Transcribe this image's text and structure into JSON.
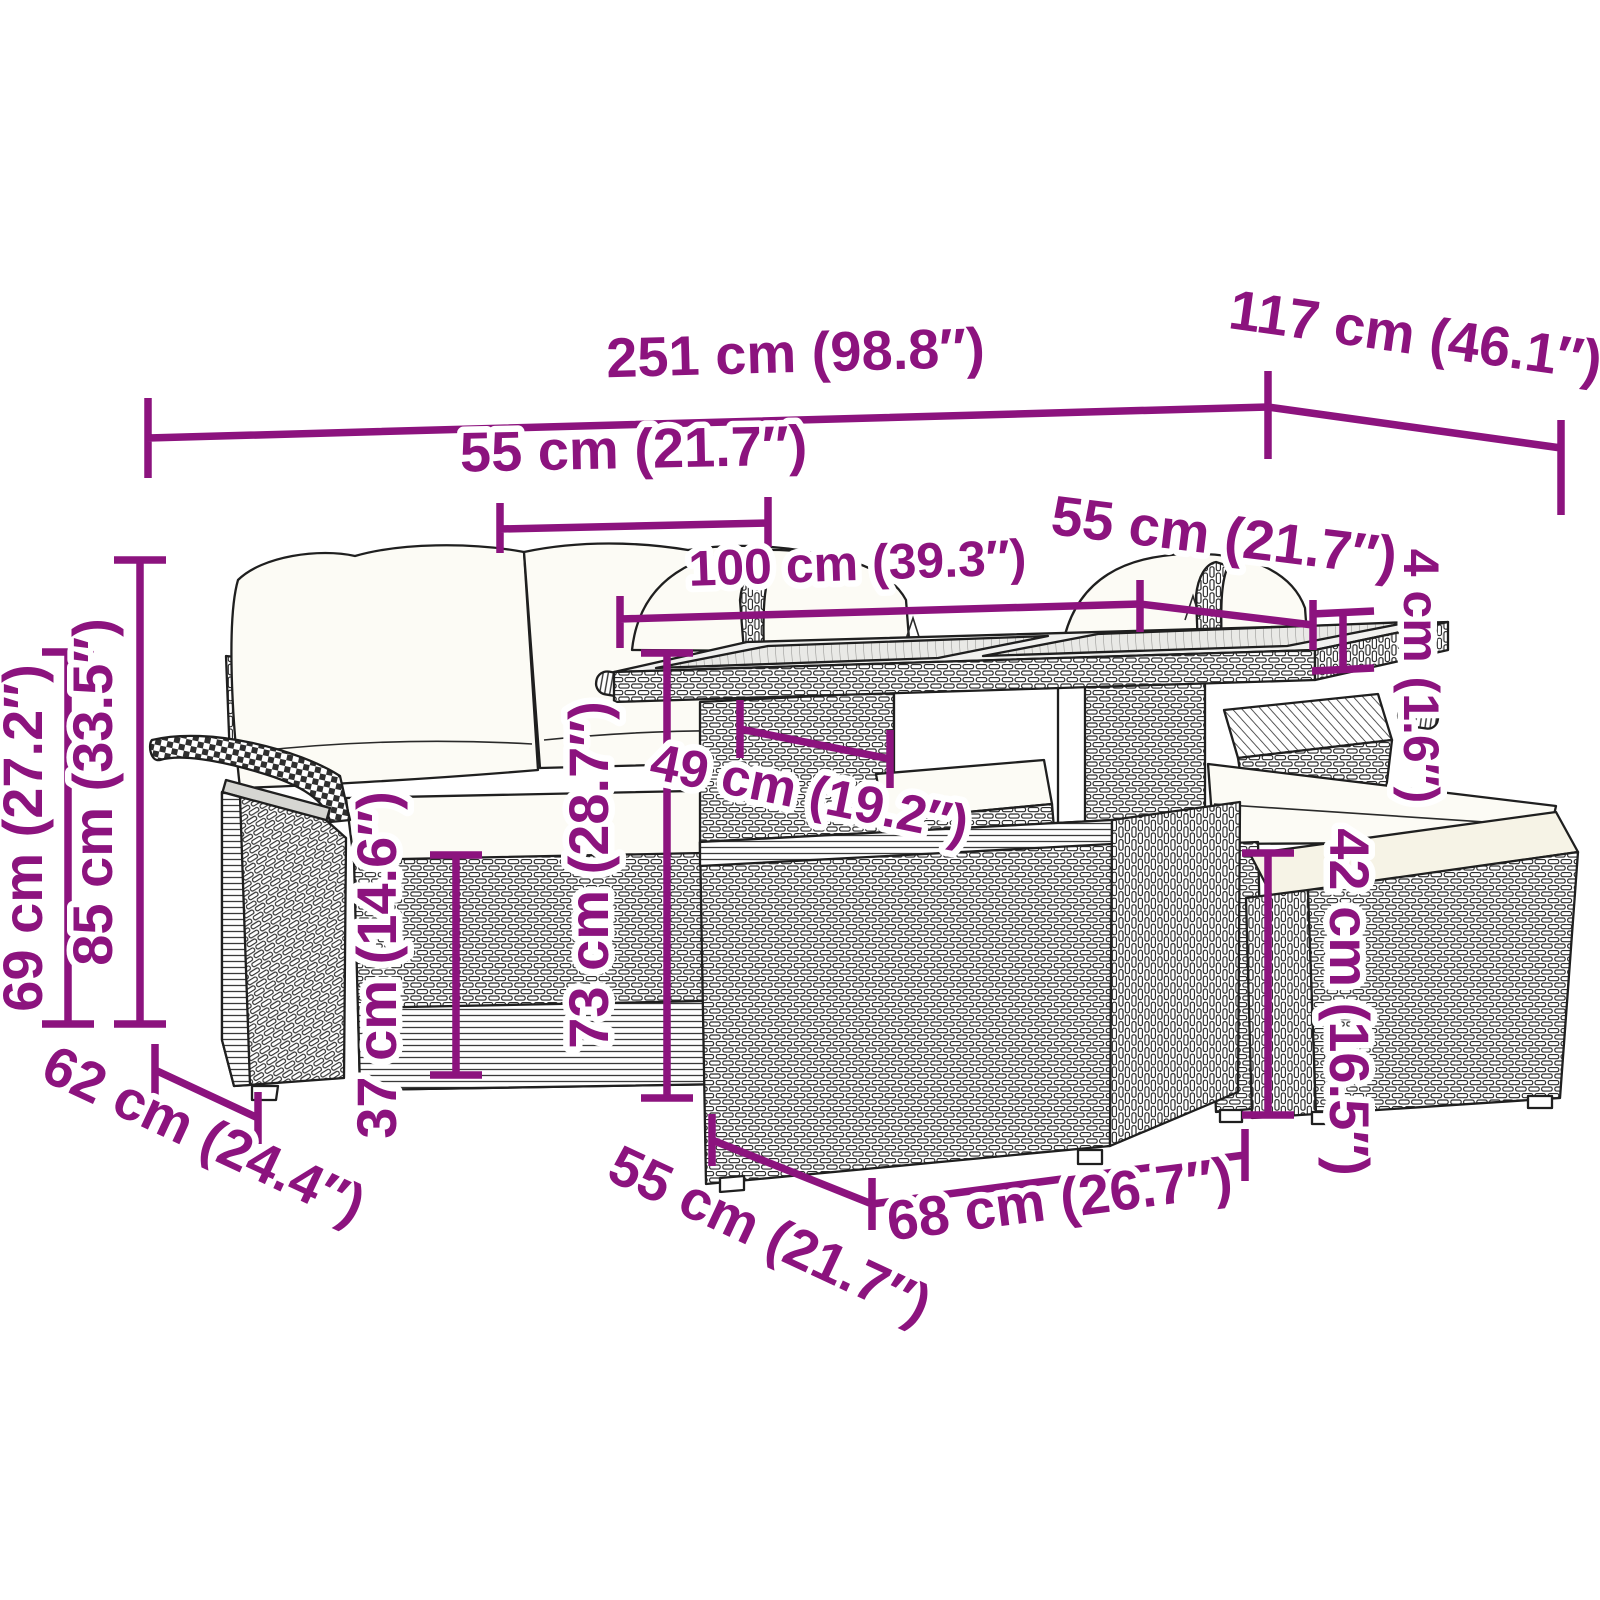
{
  "diagram": {
    "type": "product-dimension-diagram",
    "product": "rattan garden furniture set with table and stools",
    "accent_color": "#8C137E",
    "outline_color": "#1f1f1f",
    "background_color": "#ffffff"
  },
  "dimensions": {
    "overall_width": "251 cm (98.8″)",
    "overall_depth": "117 cm (46.1″)",
    "seat_section_width": "55 cm (21.7″)",
    "table_length": "100 cm (39.3″)",
    "table_depth": "55 cm (21.7″)",
    "tabletop_thickness": "4 cm (1.6″)",
    "armrest_height": "69 cm (27.2″)",
    "backrest_height": "85 cm (33.5″)",
    "seat_height": "37 cm (14.6″)",
    "table_height": "73 cm (28.7″)",
    "table_clearance_width": "49 cm (19.2″)",
    "stool_height": "42 cm (16.5″)",
    "seat_depth": "62 cm (24.4″)",
    "stool_depth": "55 cm (21.7″)",
    "stool_width": "68 cm (26.7″)"
  }
}
